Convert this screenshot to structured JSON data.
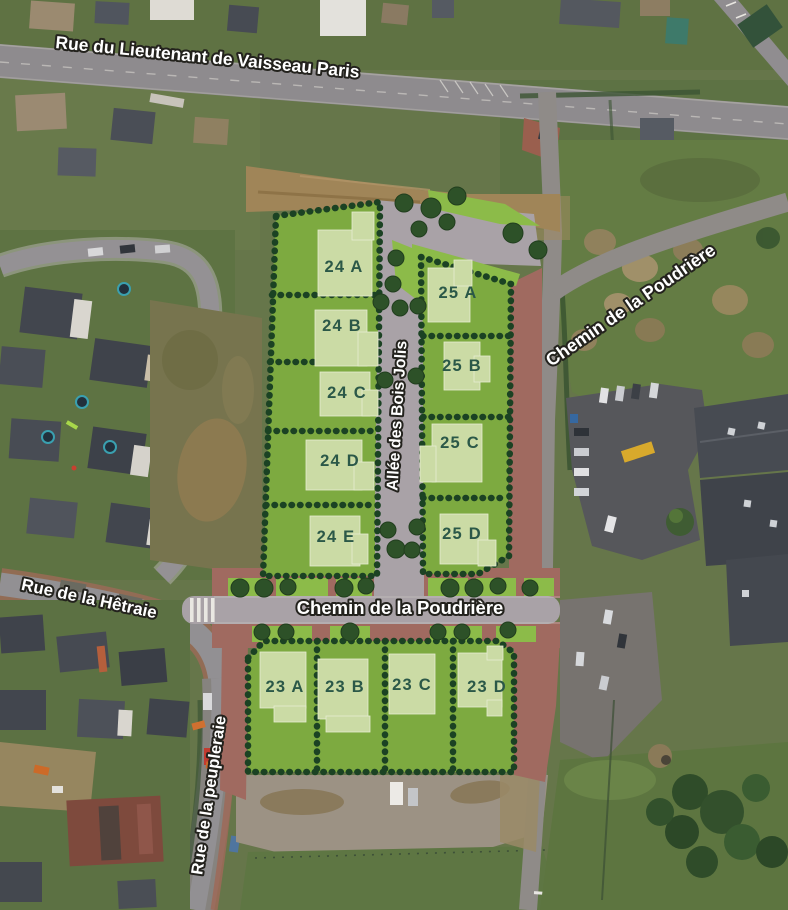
{
  "map": {
    "description": "Aerial development plan of new housing lots",
    "street_labels": [
      {
        "id": "rue-du-lieutenant-de-vaisseau-paris",
        "text": "Rue du Lieutenant de Vaisseau Paris"
      },
      {
        "id": "chemin-de-la-poudriere-east",
        "text": "Chemin de la Poudrière"
      },
      {
        "id": "allee-des-bois-jolis",
        "text": "Allée des Bois Jolis"
      },
      {
        "id": "chemin-de-la-poudriere-central",
        "text": "Chemin de la Poudrière"
      },
      {
        "id": "rue-de-la-hetraie",
        "text": "Rue de la Hêtraie"
      },
      {
        "id": "rue-de-la-peupleraie",
        "text": "Rue de la peupleraie"
      }
    ],
    "lots": [
      {
        "id": "24A",
        "label": "24 A"
      },
      {
        "id": "24B",
        "label": "24 B"
      },
      {
        "id": "24C",
        "label": "24 C"
      },
      {
        "id": "24D",
        "label": "24 D"
      },
      {
        "id": "24E",
        "label": "24 E"
      },
      {
        "id": "25A",
        "label": "25 A"
      },
      {
        "id": "25B",
        "label": "25 B"
      },
      {
        "id": "25C",
        "label": "25 C"
      },
      {
        "id": "25D",
        "label": "25 D"
      },
      {
        "id": "23A",
        "label": "23 A"
      },
      {
        "id": "23B",
        "label": "23 B"
      },
      {
        "id": "23C",
        "label": "23 C"
      },
      {
        "id": "23D",
        "label": "23 D"
      }
    ],
    "colors": {
      "available_lot_green": "#7daa40",
      "building_footprint": "#cbdba5",
      "hedge_boundary": "#1b4223",
      "new_road_gray": "#a9a2a7",
      "paved_brick": "#a06a60",
      "lot_label_text": "#2b5848",
      "street_label_fill": "#ffffff",
      "street_label_outline": "#23221d"
    }
  }
}
